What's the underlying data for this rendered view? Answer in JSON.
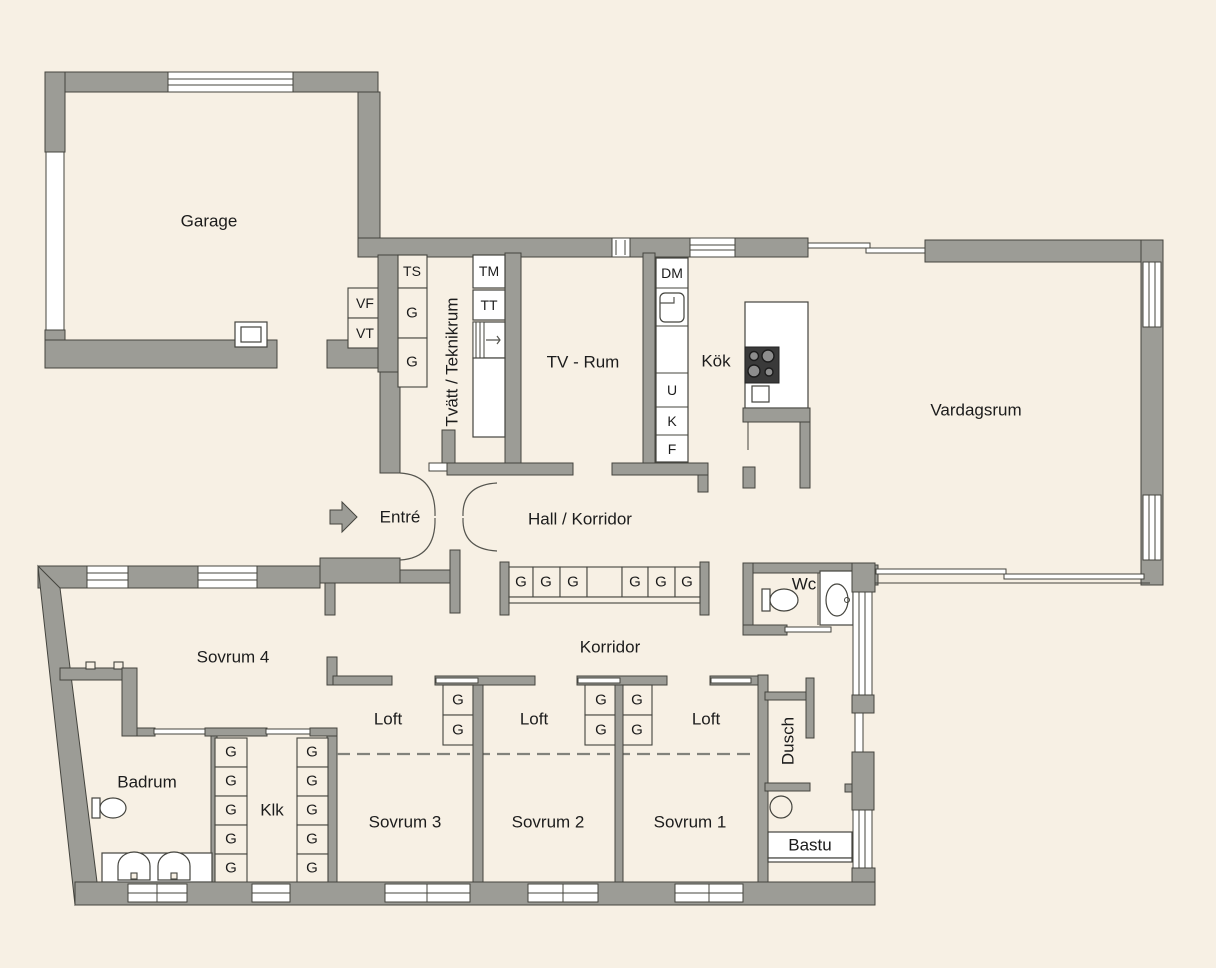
{
  "plan": {
    "title": "Floor plan (Swedish single-family house)",
    "rooms": {
      "garage": "Garage",
      "laundry": "Tvätt / Teknikrum",
      "tv": "TV - Rum",
      "kitchen": "Kök",
      "living": "Vardagsrum",
      "entry": "Entré",
      "hall": "Hall / Korridor",
      "wc": "Wc",
      "bedroom4": "Sovrum 4",
      "bathroom": "Badrum",
      "closet": "Klk",
      "loft": "Loft",
      "corridor": "Korridor",
      "bedroom3": "Sovrum 3",
      "bedroom2": "Sovrum 2",
      "bedroom1": "Sovrum 1",
      "shower": "Dusch",
      "sauna": "Bastu"
    },
    "cabinets": {
      "g": "G",
      "ts": "TS",
      "tm": "TM",
      "tt": "TT",
      "dm": "DM",
      "u": "U",
      "k": "K",
      "f": "F",
      "vf": "VF",
      "vt": "VT"
    },
    "colors": {
      "background": "#f7f0e4",
      "wall": "#9c9c96",
      "outline": "#44443e",
      "fixture": "#ffffff",
      "stove": "#3a3a3a"
    }
  }
}
